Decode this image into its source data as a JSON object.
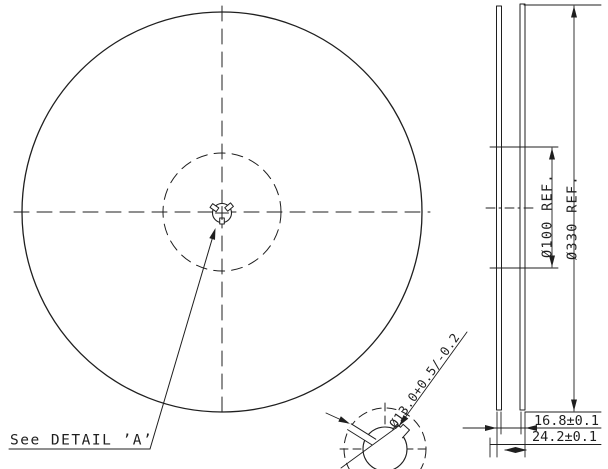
{
  "labels": {
    "see_detail": "See DETAIL ’A’"
  },
  "dimensions": {
    "hub_diameter": "Ø100 REF.",
    "flange_diameter": "Ø330 REF.",
    "inner_width": "16.8±0.1",
    "overall_width": "24.2±0.1",
    "arbor_hole": "Ø13.0+0.5/-0.2"
  },
  "colors": {
    "line": "#1f1f1f",
    "background": "#ffffff"
  }
}
